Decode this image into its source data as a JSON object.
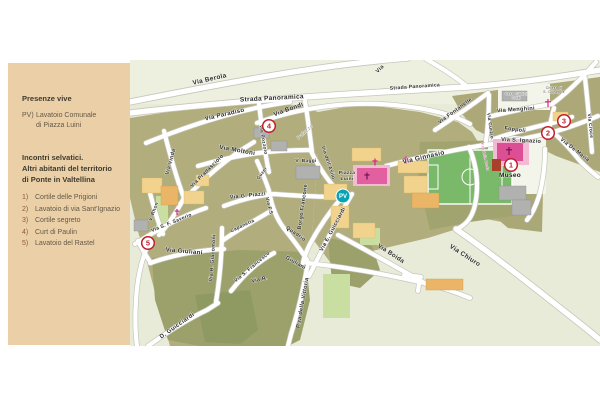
{
  "panel": {
    "section1": {
      "title": "Presenze vive",
      "entry": {
        "num": "PV)",
        "line1": "Lavatoio Comunale",
        "line2": "di Piazza Luini"
      }
    },
    "section2": {
      "title_lines": [
        "Incontri selvatici.",
        "Altri abitanti del territorio",
        "di Ponte in Valtellina"
      ]
    },
    "items": [
      {
        "num": "1)",
        "text": "Cortile delle Prigioni"
      },
      {
        "num": "2)",
        "text": "Lavatoio di via Sant'Ignazio"
      },
      {
        "num": "3)",
        "text": "Cortile segreto"
      },
      {
        "num": "4)",
        "text": "Curt di Paulin"
      },
      {
        "num": "5)",
        "text": "Lavatoio del Rastel"
      }
    ]
  },
  "map": {
    "colors": {
      "panel_bg": "#EBD0A7",
      "map_bg": "#E8EBD8",
      "urban": "#B1AD7D",
      "urban_dark": "#9CA06B",
      "road": "#FFFFFF",
      "field_green": "#79B969",
      "crops_green": "#C9DFA2",
      "building_yellow": "#F2D38D",
      "building_gray": "#B1B1AF",
      "pink": "#E2609F",
      "marker_red": "#C21F2C",
      "pv_teal": "#0AA3B4"
    },
    "street_labels": [
      {
        "t": "Via  Berola",
        "x": 210,
        "y": 81,
        "r": -13,
        "s": 6.5
      },
      {
        "t": "Strada  Panoramica",
        "x": 272,
        "y": 100,
        "r": -3,
        "s": 6.5
      },
      {
        "t": "Strada Panoramica",
        "x": 415,
        "y": 88,
        "r": -4,
        "s": 5
      },
      {
        "t": "Via",
        "x": 381,
        "y": 70,
        "r": -45,
        "s": 5.5
      },
      {
        "t": "Via  Paradiso",
        "x": 225,
        "y": 116,
        "r": -13,
        "s": 6.2
      },
      {
        "t": "Via  Bondi",
        "x": 289,
        "y": 111,
        "r": -20,
        "s": 6.2
      },
      {
        "t": "Via Pozzolo",
        "x": 262,
        "y": 140,
        "r": 80,
        "s": 4.8
      },
      {
        "t": "Via Vinda",
        "x": 172,
        "y": 162,
        "r": -75,
        "s": 5.4
      },
      {
        "t": "Via  Pradasciolo",
        "x": 208,
        "y": 172,
        "r": -45,
        "s": 5.4
      },
      {
        "t": "Via  Moltoni",
        "x": 237,
        "y": 152,
        "r": 10,
        "s": 6.2
      },
      {
        "t": "V. Rhon",
        "x": 155,
        "y": 212,
        "r": -70,
        "s": 4.8
      },
      {
        "t": "Via S. F. Saverio",
        "x": 172,
        "y": 224,
        "r": -22,
        "s": 5
      },
      {
        "t": "Via  Giuliani",
        "x": 184,
        "y": 253,
        "r": 5,
        "s": 6.2
      },
      {
        "t": "Via R. Giacomoni",
        "x": 214,
        "y": 258,
        "r": -86,
        "s": 5.2
      },
      {
        "t": "Capanetta",
        "x": 243,
        "y": 227,
        "r": -25,
        "s": 4.8
      },
      {
        "t": "Via G. Piazzi",
        "x": 248,
        "y": 197,
        "r": -6,
        "s": 5.5
      },
      {
        "t": "Guzer",
        "x": 263,
        "y": 174,
        "r": -55,
        "s": 4.6
      },
      {
        "t": "Via F.S.",
        "x": 268,
        "y": 207,
        "r": 75,
        "s": 4.8
      },
      {
        "t": "Quadrio",
        "x": 295,
        "y": 235,
        "r": 35,
        "s": 5.4
      },
      {
        "t": "Via S. Francesco",
        "x": 253,
        "y": 268,
        "r": -40,
        "s": 5
      },
      {
        "t": "Via  R.",
        "x": 260,
        "y": 281,
        "r": -12,
        "s": 5.4
      },
      {
        "t": "Giuliani",
        "x": 295,
        "y": 264,
        "r": 30,
        "s": 5.4
      },
      {
        "t": "D.  Guicciardi",
        "x": 178,
        "y": 327,
        "r": -35,
        "s": 6
      },
      {
        "t": "Borgo Francone",
        "x": 304,
        "y": 207,
        "r": -82,
        "s": 5.4
      },
      {
        "t": "Via dell'Asilo",
        "x": 327,
        "y": 163,
        "r": 72,
        "s": 5
      },
      {
        "t": "V. Baggi",
        "x": 306,
        "y": 162,
        "r": 0,
        "s": 4.8
      },
      {
        "t": "Via E. Guicciardi",
        "x": 334,
        "y": 230,
        "r": -62,
        "s": 5.6
      },
      {
        "t": "P.za della Vittoria",
        "x": 304,
        "y": 303,
        "r": -80,
        "s": 5.6
      },
      {
        "t": "Via  Boida",
        "x": 390,
        "y": 255,
        "r": 33,
        "s": 6.2
      },
      {
        "t": "Via  Chiuro",
        "x": 464,
        "y": 257,
        "r": 33,
        "s": 6.5
      },
      {
        "t": "Via  Ginnasio",
        "x": 424,
        "y": 159,
        "r": -13,
        "s": 6.5
      },
      {
        "t": "Via  S.  Ignazio",
        "x": 521,
        "y": 142,
        "r": 3,
        "s": 5.6
      },
      {
        "t": "Foppoli",
        "x": 515,
        "y": 131,
        "r": 8,
        "s": 5.4
      },
      {
        "t": "Via  Menghini",
        "x": 516,
        "y": 111,
        "r": -4,
        "s": 5.6
      },
      {
        "t": "Via Curzio",
        "x": 489,
        "y": 126,
        "r": 82,
        "s": 4.8
      },
      {
        "t": "Via Fontanelle",
        "x": 456,
        "y": 112,
        "r": -36,
        "s": 5.4
      },
      {
        "t": "Via  De Maria",
        "x": 574,
        "y": 151,
        "r": 38,
        "s": 5.4
      },
      {
        "t": "Via Croce",
        "x": 589,
        "y": 126,
        "r": 84,
        "s": 4.8
      },
      {
        "t": "Palazzo",
        "x": 306,
        "y": 133,
        "r": -42,
        "s": 5,
        "c": "#8A8A8A",
        "w": 400
      }
    ],
    "poi_labels": [
      {
        "t": "Museo",
        "x": 510,
        "y": 177,
        "s": 6.5,
        "w": 800,
        "c": "#1A1A1A",
        "n": "museo-label"
      },
      {
        "t": "Piazza",
        "x": 347,
        "y": 174,
        "s": 4.8,
        "w": 700,
        "n": "piazza-luini-label"
      },
      {
        "t": "Luini",
        "x": 347,
        "y": 180,
        "s": 4.8,
        "w": 700,
        "n": "piazza-luini-label"
      },
      {
        "t": "Casa Giudici",
        "x": 516,
        "y": 95,
        "s": 3.3,
        "c": "#666660",
        "w": 400,
        "n": "casa-giudici-label"
      },
      {
        "t": "Curzi",
        "x": 516,
        "y": 99,
        "s": 3.3,
        "c": "#666660",
        "w": 400,
        "n": "casa-giudici-label"
      },
      {
        "t": "Chiesa di",
        "x": 554,
        "y": 89,
        "s": 3.3,
        "c": "#44443E",
        "w": 400,
        "n": "chiesa-s-giuseppe-label"
      },
      {
        "t": "S. Giuseppe",
        "x": 554,
        "y": 93,
        "s": 3.3,
        "c": "#44443E",
        "w": 400,
        "n": "chiesa-s-giuseppe-label"
      },
      {
        "t": "P.za della Broda",
        "x": 484,
        "y": 157,
        "r": 78,
        "s": 3.3,
        "c": "#C2187E",
        "w": 400,
        "n": "pza-della-broda-label"
      }
    ],
    "markers": [
      {
        "n": "1",
        "x": 511,
        "y": 165
      },
      {
        "n": "2",
        "x": 548,
        "y": 133
      },
      {
        "n": "3",
        "x": 564,
        "y": 121
      },
      {
        "n": "4",
        "x": 269,
        "y": 126
      },
      {
        "n": "5",
        "x": 148,
        "y": 243
      }
    ],
    "pv_badge": {
      "label": "PV",
      "x": 343,
      "y": 196
    },
    "crosses": [
      {
        "x": 548,
        "y": 103,
        "s": 4,
        "c": "#D6258C"
      },
      {
        "x": 375,
        "y": 162,
        "s": 3.5,
        "c": "#D6258C"
      },
      {
        "x": 406,
        "y": 160,
        "s": 3.5,
        "c": "#D6258C"
      },
      {
        "x": 177,
        "y": 212,
        "s": 3,
        "c": "#D6258C"
      },
      {
        "x": 367,
        "y": 176,
        "s": 3.5,
        "c": "#7A1150"
      },
      {
        "x": 509,
        "y": 151,
        "s": 4,
        "c": "#7A1150"
      }
    ]
  }
}
